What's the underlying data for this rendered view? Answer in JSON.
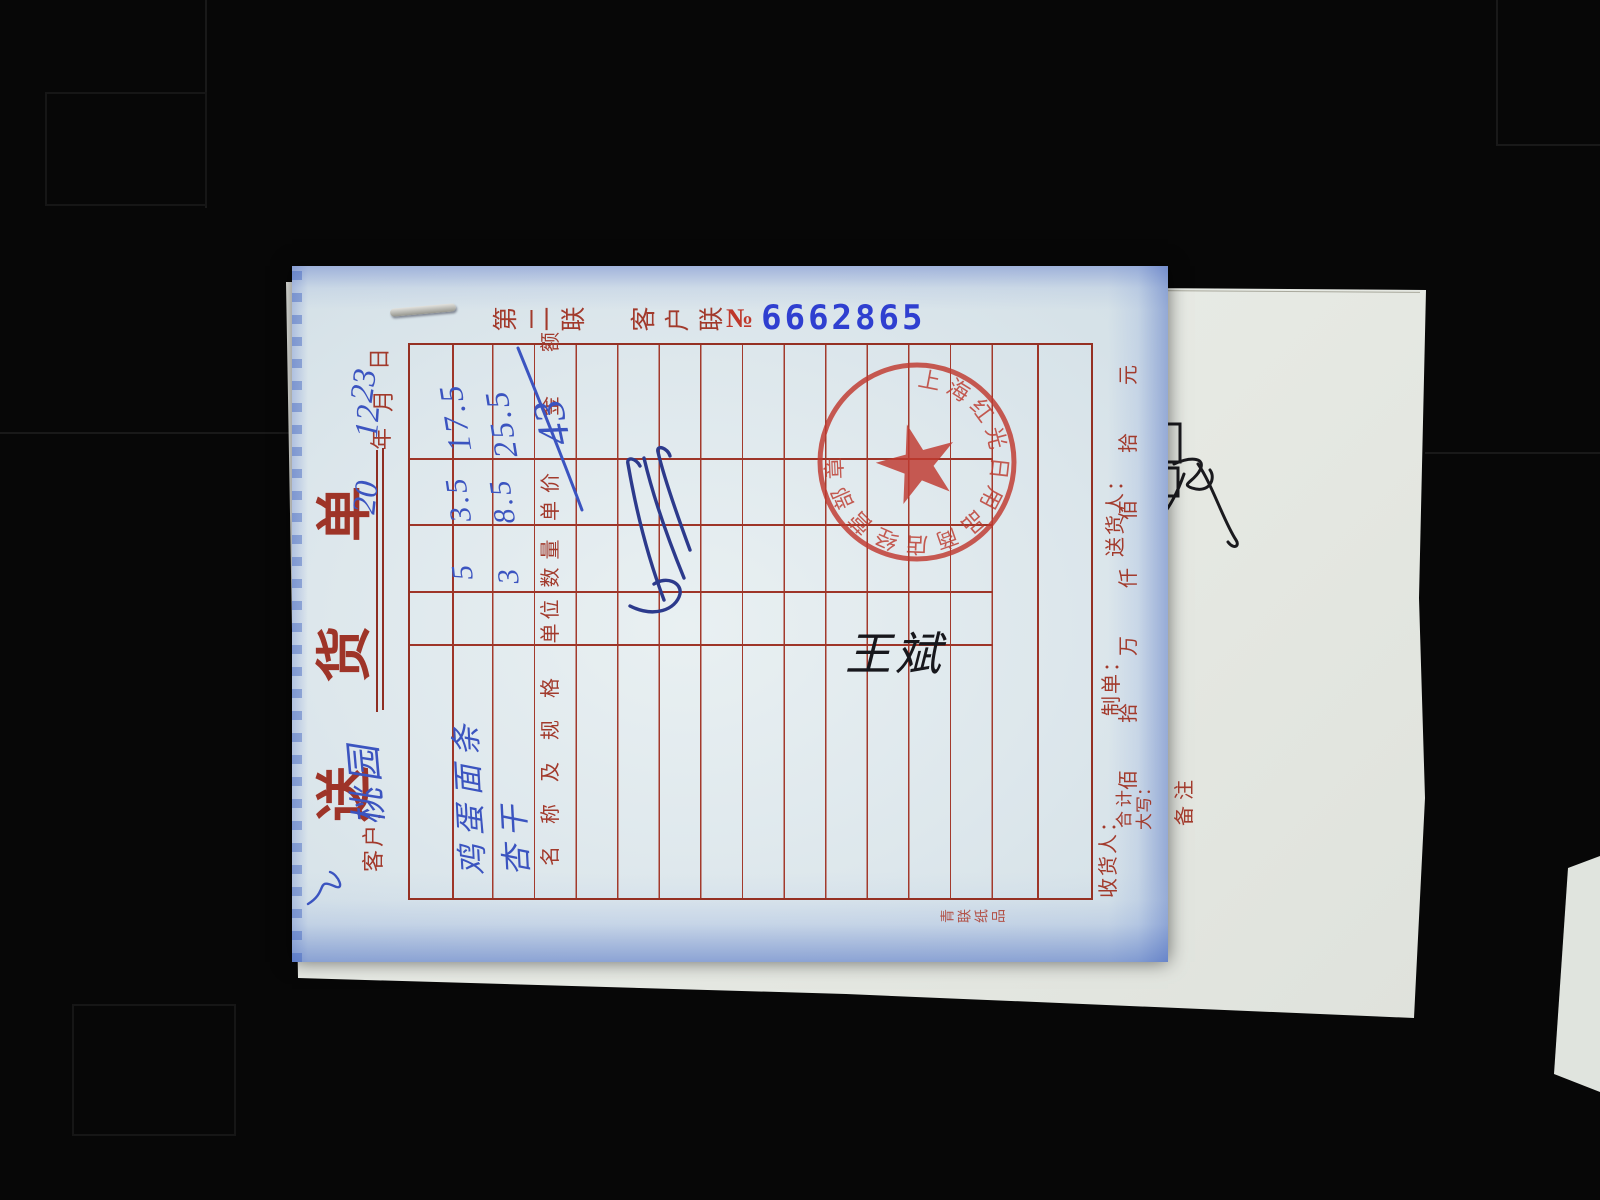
{
  "note": {
    "title": "送货单",
    "copy_label": "第二联 客户联",
    "serial_prefix": "№",
    "serial_number": "6662865",
    "customer_label": "客户：",
    "customer_name": "桃园",
    "date": {
      "y_hand": "20",
      "y": "年",
      "m_hand": "12",
      "m": "月",
      "d_hand": "23",
      "d": "日"
    },
    "table": {
      "col_name": "名称及规格",
      "col_unit": "单位",
      "col_qty": "数量",
      "col_price": "单价",
      "col_amount": "金额",
      "rows": [
        {
          "name": "鸡蛋面条",
          "unit": "",
          "qty": "5",
          "price": "3.5",
          "amount": "17.5"
        },
        {
          "name": "杏干",
          "unit": "",
          "qty": "3",
          "price": "8.5",
          "amount": "25.5"
        }
      ],
      "total": "43",
      "sum_label_top": "合计",
      "sum_label_bottom": "大写：",
      "denominations": [
        "佰",
        "拾",
        "万",
        "仟",
        "佰",
        "拾",
        "元"
      ],
      "remark_label": "备注"
    },
    "footer_receiver": "收货人：",
    "footer_maker": "制单：",
    "footer_deliverer": "送货人：",
    "edge_mark": "青联纸品",
    "handwritten_signature": "王斌",
    "stamp_arc_text": "上海红光日用品商店经营部章",
    "stamp_star": "★"
  },
  "back_sheet": {
    "maker_label": "制单人：",
    "maker_value": "王振弟",
    "auditor_label": "审核人：",
    "auditor_value": "",
    "supervisor_label": "主管签名：",
    "supervisor_value": "",
    "total_label": "总金额：",
    "total_value": "43"
  },
  "colors": {
    "print_red": "#a23a2c",
    "pen_blue": "#3b54c0",
    "serial_blue": "#2f3fd0",
    "stamp_red": "#c0392f",
    "sheet_tint": "#dde7ec"
  }
}
